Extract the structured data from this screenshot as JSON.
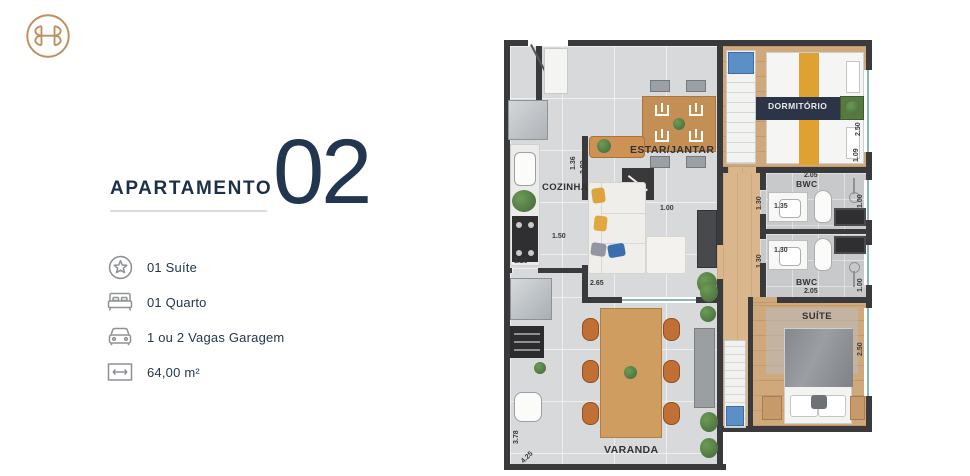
{
  "colors": {
    "navy_text": "#1d3049",
    "brand_gold": "#bf8f60",
    "wall": "#3a3a3c",
    "wood_floor": "#cfa87c",
    "tile_floor": "#d8d9db",
    "accent_blue_furniture": "#5d8fc7",
    "bed_runner_orange": "#dfa232"
  },
  "panel": {
    "title": "APARTAMENTO",
    "unit_number": "02",
    "features": [
      {
        "icon": "star-circle-icon",
        "label": "01 Suíte"
      },
      {
        "icon": "bed-icon",
        "label": "01 Quarto"
      },
      {
        "icon": "car-icon",
        "label": "1 ou 2 Vagas Garagem"
      },
      {
        "icon": "area-width-icon",
        "label": "64,00 m²"
      }
    ]
  },
  "floorplan": {
    "rooms": {
      "estar": "ESTAR/JANTAR",
      "cozinha": "COZINHA",
      "dormitorio": "DORMITÓRIO",
      "bwc1": "BWC",
      "bwc2": "BWC",
      "suite": "SUÍTE",
      "varanda": "VARANDA"
    },
    "dims": [
      "1.50",
      "1.20",
      "2.65",
      "1.00",
      "1.36",
      "2.92",
      "2.05",
      "1.35",
      "1.30",
      "1.30",
      "1.30",
      "2.05",
      "1.00",
      "1.00",
      "2.50",
      "2.50",
      "1.09",
      "3.78",
      "4.25"
    ]
  }
}
